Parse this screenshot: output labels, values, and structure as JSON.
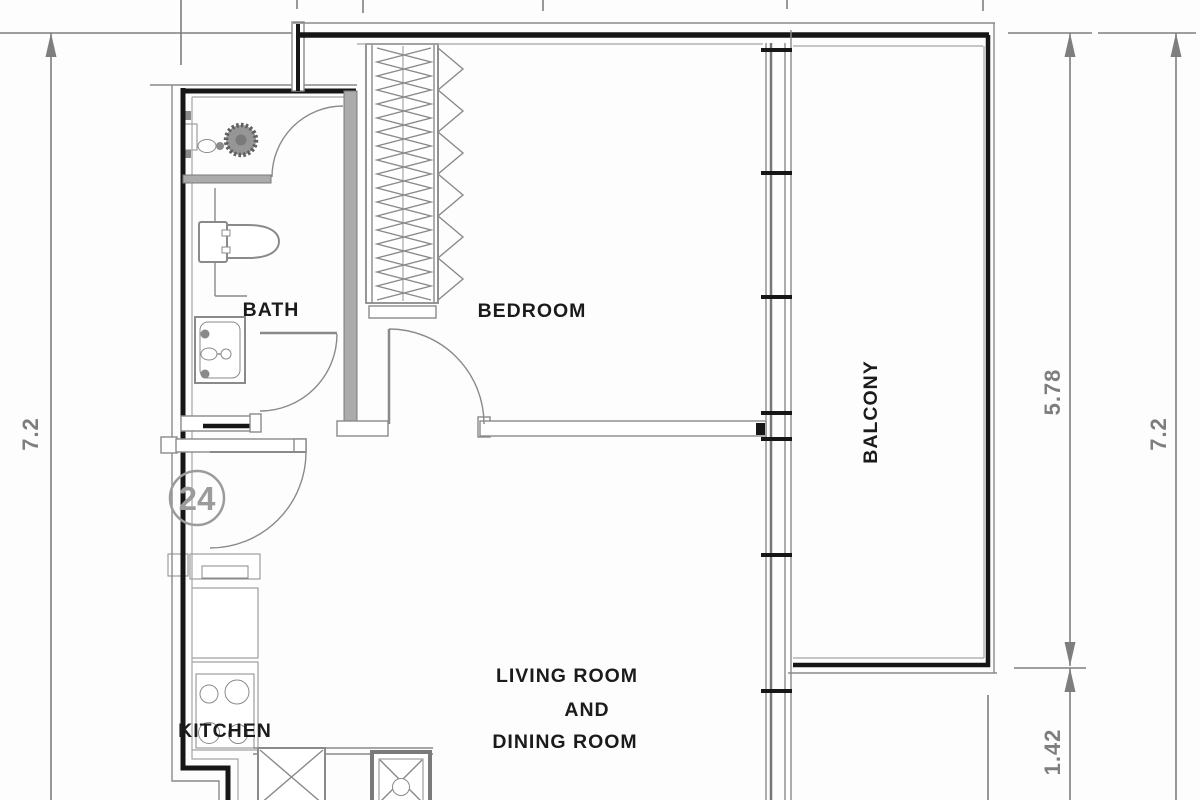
{
  "drawing": {
    "type_note": "apartment floor plan",
    "unit_number": "24",
    "rooms": {
      "bath": "BATH",
      "bedroom": "BEDROOM",
      "balcony": "BALCONY",
      "kitchen": "KITCHEN",
      "living_line1": "LIVING ROOM",
      "living_line2": "AND",
      "living_line3": "DINING ROOM"
    },
    "dimensions": {
      "left_height": "7.2",
      "balcony_height": "5.78",
      "right_height": "7.2",
      "below_balcony": "1.42"
    },
    "colors": {
      "wall_black": "#161616",
      "line_gray": "#8a8a8a",
      "dimension_gray": "#7e7e7e",
      "label_black": "#1b1b1b",
      "unit_gray": "#9b9b9b",
      "background": "#fdfdfd"
    }
  }
}
